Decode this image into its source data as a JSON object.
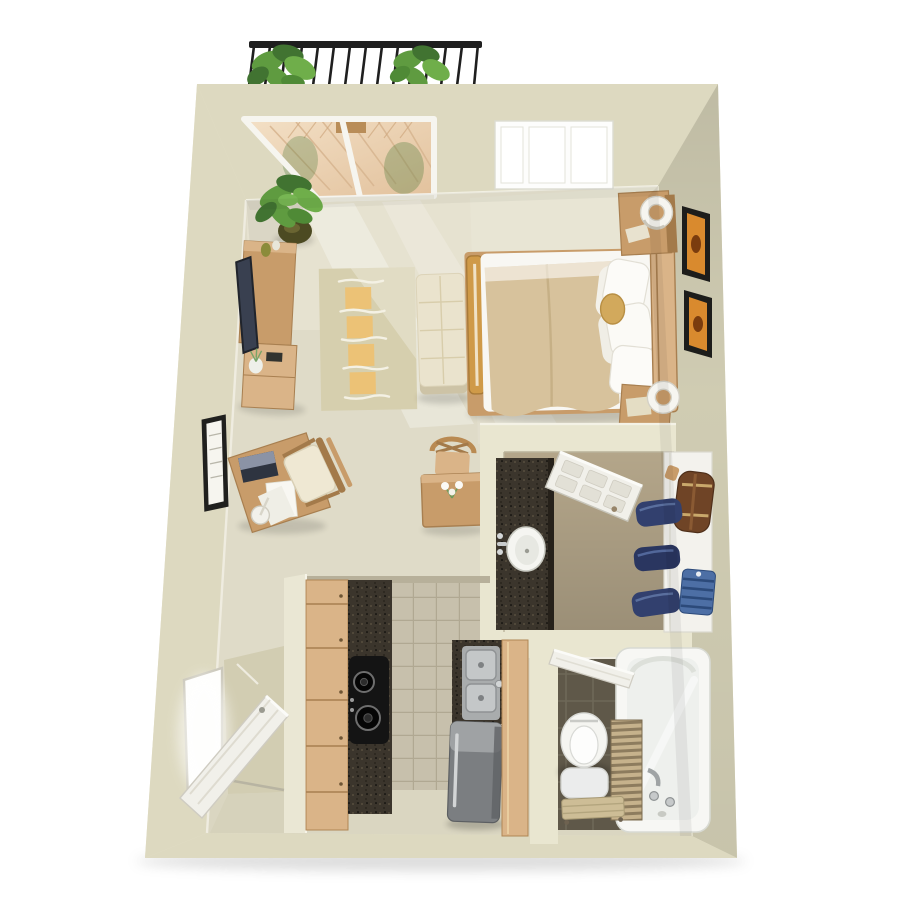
{
  "meta": {
    "scene": "studio-apartment-3d-floor-plan",
    "view": "top-down"
  },
  "colors": {
    "wall_top": "#e9e6d0",
    "wall_face": "#ddd9c0",
    "wall_face_dark": "#d4d0b6",
    "floor": "#dfdbc8",
    "floor_light": "#f0ecda",
    "floor_shadow": "#d6d2bb",
    "rug_base": "#d6cfae",
    "rug_accent": "#ecc276",
    "wood": "#c89c6a",
    "wood_light": "#dab488",
    "wood_dark": "#a37a4a",
    "duvet": "#d7c29c",
    "linen": "#f8f7f3",
    "ottoman": "#eae3cd",
    "tv_screen": "#394050",
    "leaf": "#5f9b40",
    "leaf_dark": "#417331",
    "granite": "#3b352c",
    "kitchen_tile": "#c7c0ac",
    "bath_tile": "#5f5849",
    "steel": "#c4c7c8",
    "fridge": "#7b7e81",
    "porcelain": "#f5f5f1",
    "closet_floor": "#b4a68a",
    "door_white": "#f1f0ea",
    "denim": "#32406e",
    "duffel": "#6f4426",
    "shirt": "#4d6fa5",
    "gold_pillow": "#d2a95c",
    "art_orange": "#d98a2e",
    "iron": "#1f1f1f",
    "deck": "#ead0b3"
  },
  "rooms": {
    "balcony": {
      "items": [
        "railing",
        "planter-left",
        "planter-right",
        "wood-deck"
      ]
    },
    "living_sleeping": {
      "items": [
        "sliding-glass-door",
        "window",
        "bed",
        "duvet",
        "pillows",
        "round-pillow",
        "headboard",
        "nightstand-upper",
        "nightstand-lower",
        "drum-lamp-upper",
        "drum-lamp-lower",
        "ottoman-bench",
        "area-rug",
        "tv-console",
        "television",
        "potted-plant",
        "wall-art-upper",
        "wall-art-lower",
        "certificate-frame",
        "desk",
        "desk-chair",
        "laptop",
        "papers",
        "desk-lamp",
        "dining-table",
        "dining-chair",
        "flowers"
      ]
    },
    "dressing": {
      "items": [
        "vanity-counter",
        "vanity-sink",
        "open-door",
        "closet-shelf",
        "duffel-bag",
        "hanging-jeans",
        "folded-shirt"
      ]
    },
    "kitchen": {
      "items": [
        "cabinet-run-left",
        "granite-counter",
        "cooktop",
        "tile-floor",
        "double-sink",
        "refrigerator",
        "cabinet-panel-right"
      ]
    },
    "bathroom": {
      "items": [
        "toilet",
        "step-bench",
        "privacy-screen",
        "bathtub",
        "tub-faucet",
        "open-door",
        "dark-tile-floor"
      ]
    },
    "entry": {
      "items": [
        "front-door",
        "doorway-opening"
      ]
    }
  }
}
